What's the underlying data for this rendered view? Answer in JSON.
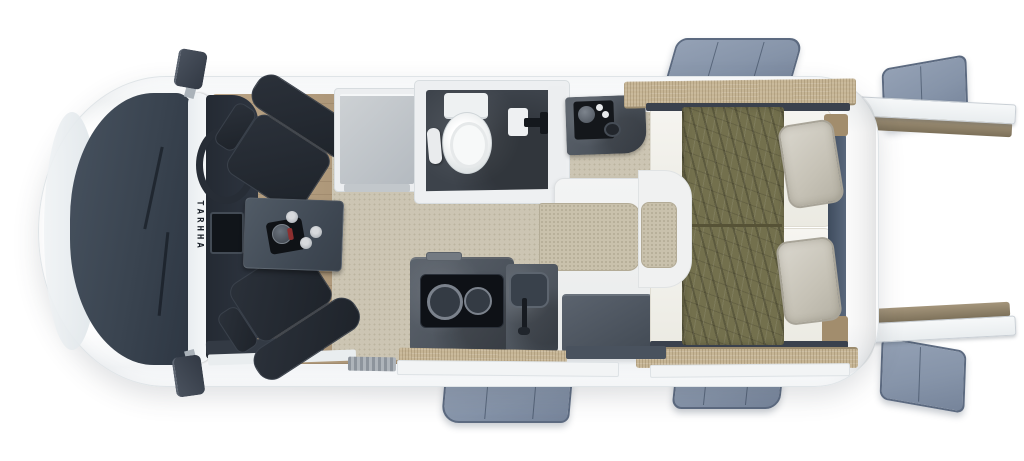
{
  "scene": {
    "type": "motorhome-floorplan-top-view",
    "brand_marking": "TARHHA"
  },
  "colors": {
    "background": "#ffffff",
    "van_body": "#f4f6f7",
    "cab_hood": "#3d4754",
    "seat": "#23282f",
    "wood_floor": "#b19978",
    "carpet": "#ccc5b3",
    "dinette_table": "#49535e",
    "bathroom_floor": "#3d434b",
    "toilet": "#f2f4f5",
    "kitchen_counter": "#4a525c",
    "hob": "#0e1116",
    "bench_cushion": "#c9c1ac",
    "mattress": "#f3f2ed",
    "blanket_olive": "#73704d",
    "pillow": "#cfccc2",
    "window_flap": "#8694a9",
    "wood_shelf": "#c6b595",
    "rear_window": "#4d5a6c"
  },
  "objects": {
    "cab": "driver cab with two swivel seats and steering wheel",
    "dinette": "table with moka pot and cups",
    "bathroom": "toilet, towel, shower head",
    "vanity": "washbasin counter",
    "kitchen": "two-burner hob and sink",
    "bedroom": "twin beds with olive blankets and pillows",
    "openings": "six opened window flaps and rear shelves"
  }
}
